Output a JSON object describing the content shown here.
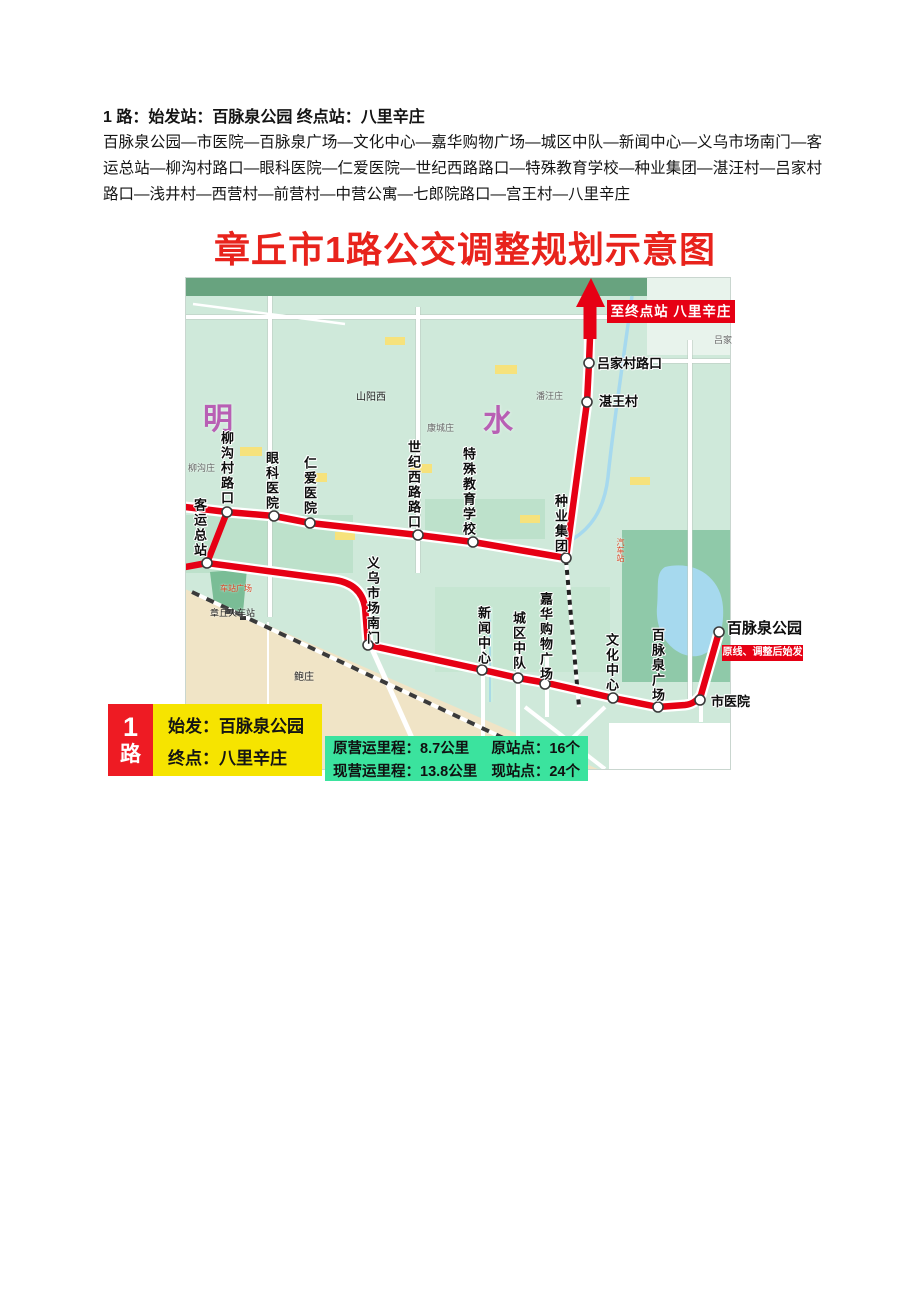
{
  "header": {
    "heading": "1 路：始发站：百脉泉公园  终点站：八里辛庄",
    "description": "百脉泉公园—市医院—百脉泉广场—文化中心—嘉华购物广场—城区中队—新闻中心—义乌市场南门—客运总站—柳沟村路口—眼科医院—仁爱医院—世纪西路路口—特殊教育学校—种业集团—湛汪村—吕家村路口—浅井村—西营村—前营村—中营公寓—七郎院路口—宫王村—八里辛庄"
  },
  "map": {
    "title": "章丘市1路公交调整规划示意图",
    "terminal_banner": "至终点站 八里辛庄",
    "origin_banner": "原线、调整后始发",
    "area_labels": {
      "ming": "明",
      "shui": "水"
    },
    "stations": [
      {
        "label": "百脉泉公园"
      },
      {
        "label": "市医院"
      },
      {
        "label": "百脉泉广场"
      },
      {
        "label": "文化中心"
      },
      {
        "label": "嘉华购物广场"
      },
      {
        "label": "城区中队"
      },
      {
        "label": "新闻中心"
      },
      {
        "label": "义乌市场南门"
      },
      {
        "label": "客运总站"
      },
      {
        "label": "柳沟村路口"
      },
      {
        "label": "眼科医院"
      },
      {
        "label": "仁爱医院"
      },
      {
        "label": "世纪西路路口"
      },
      {
        "label": "特殊教育学校"
      },
      {
        "label": "种业集团"
      },
      {
        "label": "湛王村"
      },
      {
        "label": "吕家村路口"
      }
    ],
    "places": {
      "shanyangxi": "山阳西",
      "liugouzhuang": "柳沟庄",
      "panwangzhuang": "潘汪庄",
      "kangchengzhuang": "康城庄",
      "baozhuang": "鲍庄",
      "lyujia": "吕家",
      "railway_station": "章丘火车站",
      "station_square": "车站广场",
      "bus_station": "汽车站"
    },
    "colors": {
      "route_red": "#e60014",
      "map_background": "#cfe9da",
      "beige_area": "#f0e4c6",
      "water_blue": "#a6d9ee",
      "title_red": "#e8231c"
    }
  },
  "legend": {
    "route_number": "1",
    "route_word": "路",
    "start": "始发：百脉泉公园",
    "end": "终点：八里辛庄",
    "old_mileage": "原营运里程：8.7公里",
    "old_stops": "原站点：16个",
    "new_mileage": "现营运里程：13.8公里",
    "new_stops": "现站点：24个"
  }
}
